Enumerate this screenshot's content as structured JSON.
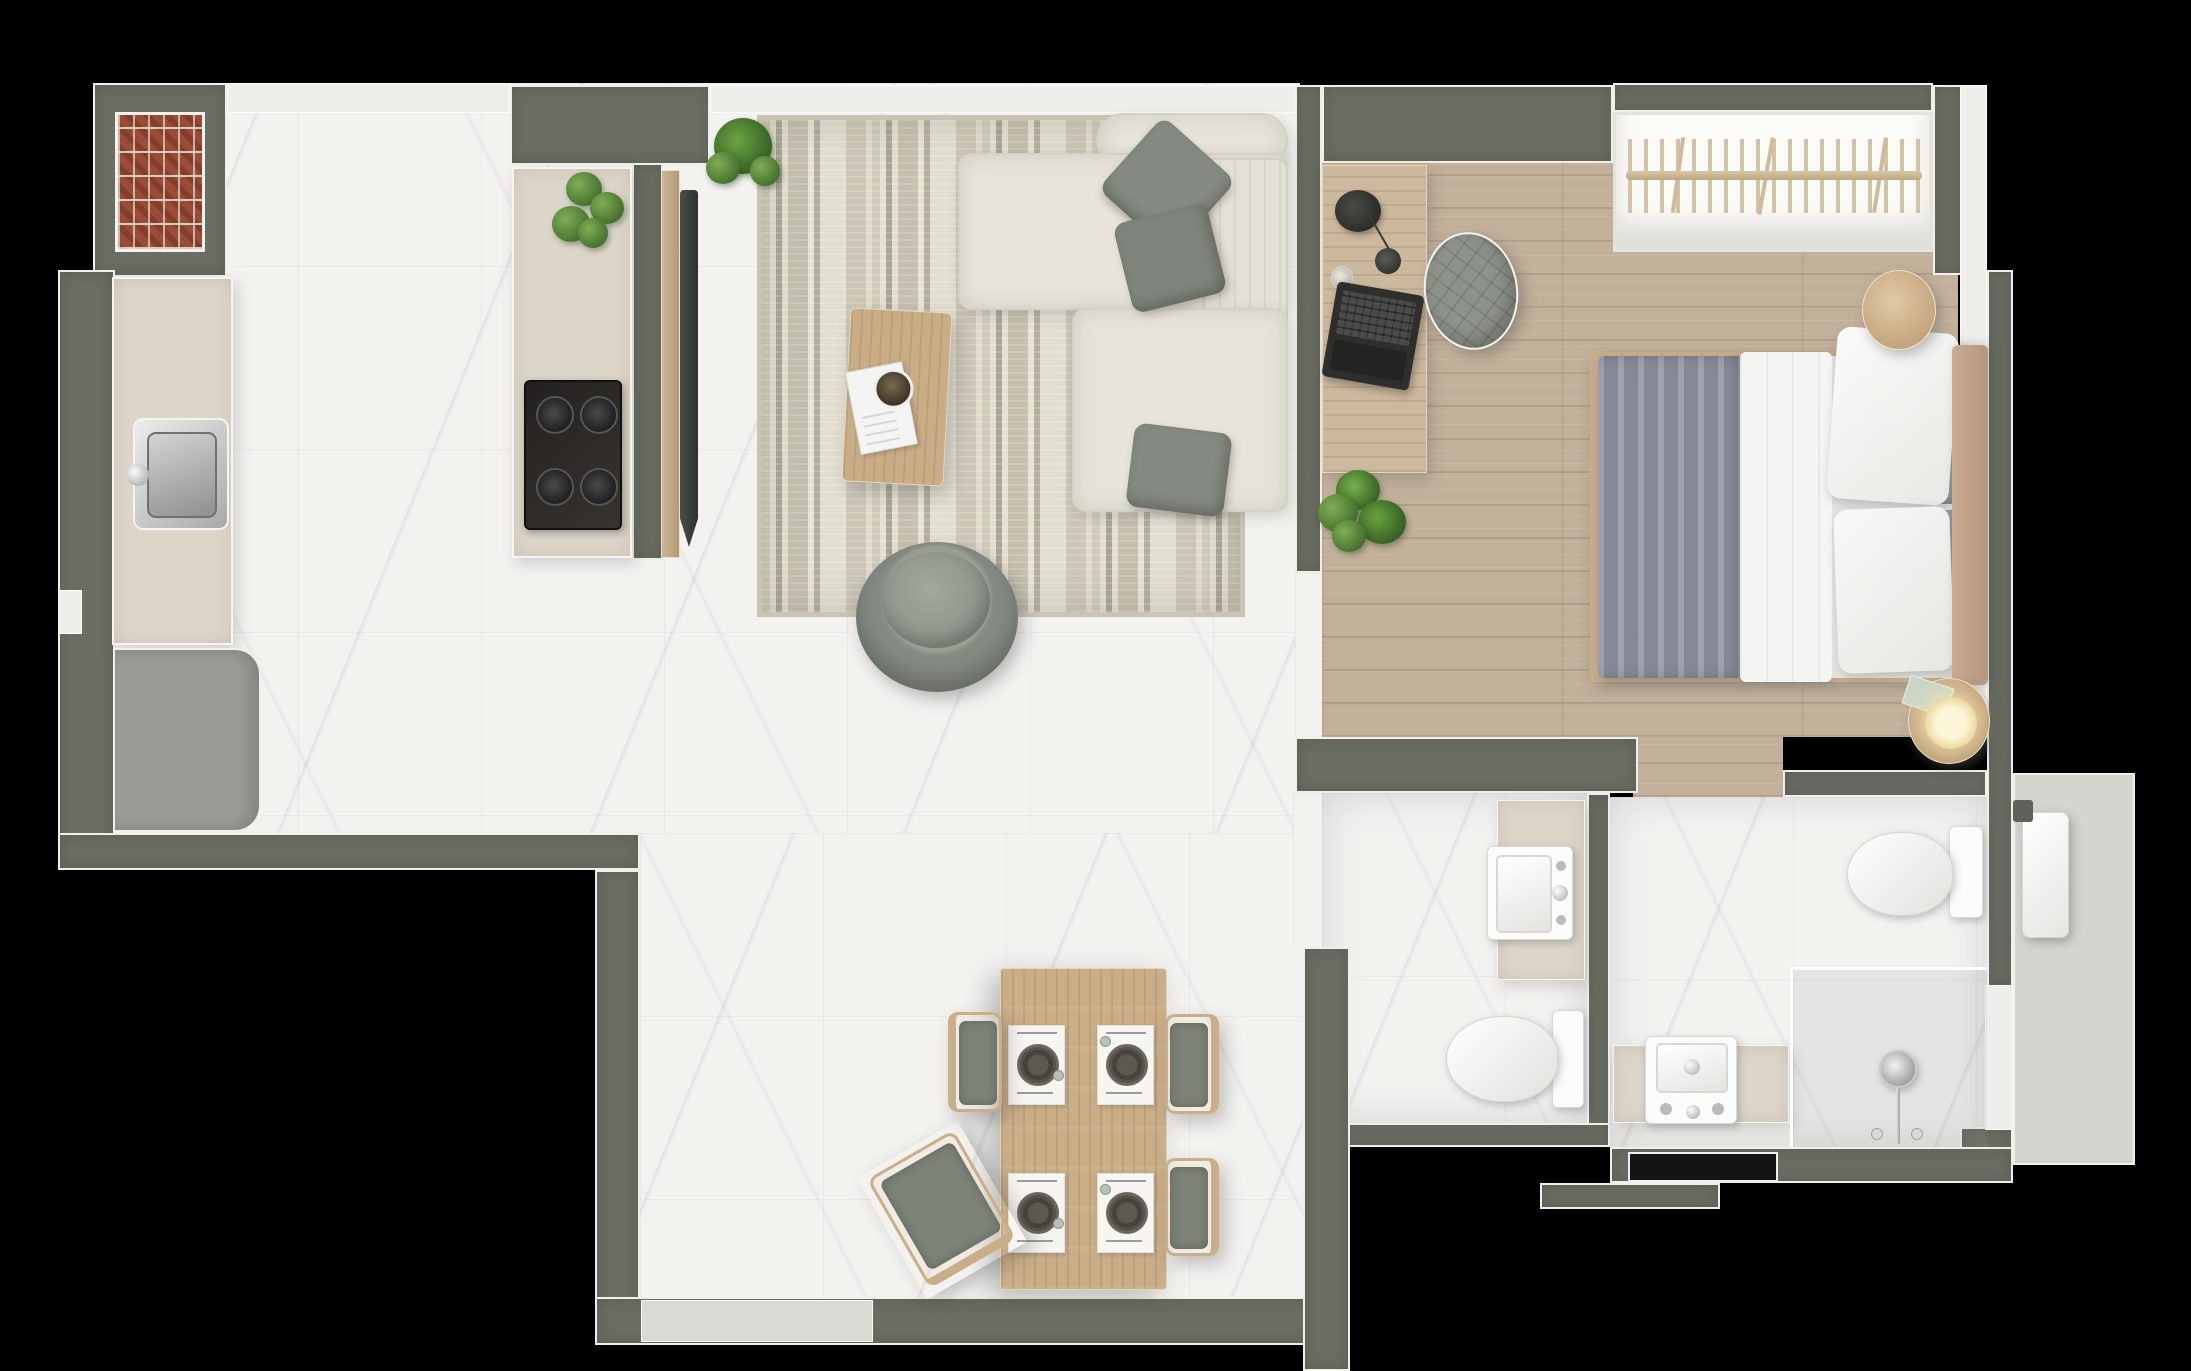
{
  "app": {
    "title": "Apartment floor plan – top-down 3D render",
    "view": "top-down",
    "background": "#000000"
  },
  "palette": {
    "wall": "#696d62",
    "wall_outline": "#eff0ea",
    "marble_floor": "#f3f2ef",
    "wood_floor": "#c2b09a",
    "balcony_floor": "#d6d4ce",
    "counter_beige": "#dcd6c9",
    "sofa_fabric": "#e7e4db",
    "pillow_green": "#858b82",
    "rug_base": "#ddd9cb",
    "rug_stripe": "#a9a494",
    "dining_wood": "#c9ae88",
    "brick": "#9a4c36",
    "tv_black": "#3c403e",
    "seat_green": "#7d8378",
    "blanket_gray": "#9095a2"
  },
  "rooms": [
    {
      "id": "living",
      "name": "Kitchen / Living / Dining",
      "floor": "white marble tile"
    },
    {
      "id": "bedroom",
      "name": "Bedroom",
      "floor": "light oak planks"
    },
    {
      "id": "bath1",
      "name": "Bathroom 1",
      "floor": "white marble tile"
    },
    {
      "id": "bath2",
      "name": "Bathroom 2 (en-suite)",
      "floor": "white marble tile"
    },
    {
      "id": "balcony",
      "name": "Utility balcony",
      "floor": "concrete"
    }
  ],
  "counts": {
    "sofa_pillows": 3,
    "cooktop_burners": 4,
    "dining_place_settings": 4,
    "dining_chairs": 4,
    "bed_pillows": 4,
    "wardrobe_hangers": 19
  },
  "items": {
    "brick_feature": {
      "label": "Brick feature column"
    },
    "kitchen_counter": {
      "label": "Kitchen counter"
    },
    "kitchen_sink": {
      "label": "Stainless steel sink"
    },
    "refrigerator": {
      "label": "Refrigerator cabinet"
    },
    "kitchen_island": {
      "label": "Kitchen island"
    },
    "cooktop": {
      "label": "Four-burner cooktop"
    },
    "island_plant": {
      "label": "Potted plant on island"
    },
    "corner_plant": {
      "label": "Potted plant"
    },
    "tv_panel": {
      "label": "Wooden TV panel"
    },
    "tv": {
      "label": "Wall-mounted TV"
    },
    "rug": {
      "label": "Patterned boho area rug"
    },
    "sofa": {
      "label": "Sectional sofa with chaise"
    },
    "sofa_pillow": {
      "label": "Throw pillow"
    },
    "coffee_table": {
      "label": "Wooden coffee table"
    },
    "magazine": {
      "label": "Magazine"
    },
    "bowl": {
      "label": "Decorative bowl"
    },
    "armchair": {
      "label": "Round lounge armchair"
    },
    "dining_table": {
      "label": "Dining table"
    },
    "place_setting": {
      "label": "Place setting"
    },
    "dining_chair": {
      "label": "Dining chair"
    },
    "desk": {
      "label": "Desk"
    },
    "desk_lamp": {
      "label": "Desk lamp"
    },
    "laptop": {
      "label": "Laptop"
    },
    "pouf": {
      "label": "Upholstered pouf"
    },
    "bedroom_plant": {
      "label": "Floor plant"
    },
    "wardrobe": {
      "label": "Open wardrobe rail with hangers"
    },
    "bed": {
      "label": "Double bed"
    },
    "blanket": {
      "label": "Gray blanket"
    },
    "duvet": {
      "label": "White duvet"
    },
    "bed_pillow": {
      "label": "Bed pillow"
    },
    "headboard": {
      "label": "Upholstered headboard"
    },
    "nightstand_top": {
      "label": "Round side table"
    },
    "nightstand_lamp": {
      "label": "Round side table with lamp"
    },
    "vanity_sink_1": {
      "label": "Vanity sink"
    },
    "toilet_1": {
      "label": "Toilet"
    },
    "toilet_2": {
      "label": "Toilet"
    },
    "vanity_sink_2": {
      "label": "Vanity sink"
    },
    "shower": {
      "label": "Walk-in shower"
    },
    "entry_mat": {
      "label": "Entry door mat"
    },
    "water_heater": {
      "label": "Water heater cabinet"
    }
  }
}
